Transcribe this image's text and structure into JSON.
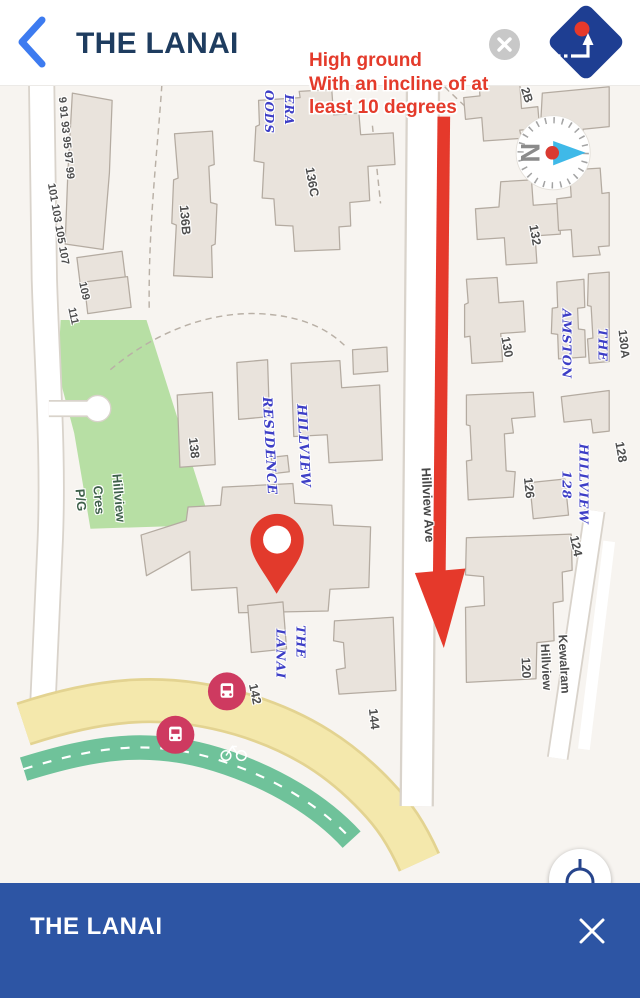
{
  "header": {
    "title": "THE LANAI"
  },
  "annotation": {
    "lines": [
      "High ground",
      "With an incline of at",
      "least 10 degrees"
    ]
  },
  "bottom_bar": {
    "title": "THE LANAI"
  },
  "compass": {
    "cardinal": "N"
  },
  "theme": {
    "bar_blue": "#2d55a4",
    "logo_blue": "#1e3e92",
    "header_title_navy": "#1e3c5f",
    "back_chevron_blue": "#3d7bf0",
    "annotation_red": "#e43b2b",
    "arrow_red": "#e5392b",
    "pin_red": "#e23a2c",
    "bus_stop_pink": "#ce3a60",
    "park_green": "#b7dfa4",
    "road_yellow": "#f4e8ac",
    "cycle_path_teal": "#6fc29a",
    "condo_label_blue": "#3d3ec6",
    "building_fill": "#e9e3dc",
    "map_background": "#f7f4f0"
  },
  "icons": {
    "header": [
      "back-chevron-icon",
      "close-circle-icon",
      "app-logo-diamond-icon"
    ],
    "map": [
      "compass-rose-icon",
      "map-pin-icon",
      "bus-stop-icon",
      "bicycle-icon",
      "my-location-icon"
    ],
    "bottom_bar": [
      "close-x-icon"
    ]
  },
  "map": {
    "labels": [
      {
        "text": "9 91 93 95 97 99",
        "x": 66,
        "y": 138,
        "rot": 84,
        "cls": "num",
        "size": 11
      },
      {
        "text": "101 103 105 107",
        "x": 58,
        "y": 224,
        "rot": 80,
        "cls": "num",
        "size": 11
      },
      {
        "text": "109",
        "x": 84,
        "y": 291,
        "rot": 78,
        "cls": "num",
        "size": 11
      },
      {
        "text": "111",
        "x": 73,
        "y": 316,
        "rot": 78,
        "cls": "num",
        "size": 11
      },
      {
        "text": "136B",
        "x": 185,
        "y": 220,
        "rot": 85,
        "cls": "num",
        "size": 12.5
      },
      {
        "text": "136C",
        "x": 312,
        "y": 182,
        "rot": 80,
        "cls": "num",
        "size": 12.5
      },
      {
        "text": "ERA",
        "x": 289,
        "y": 110,
        "rot": 90,
        "cls": "condo",
        "size": 12
      },
      {
        "text": "OODS",
        "x": 269,
        "y": 112,
        "rot": 90,
        "cls": "condo",
        "size": 12
      },
      {
        "text": "2B",
        "x": 527,
        "y": 95,
        "rot": 72,
        "cls": "num",
        "size": 12
      },
      {
        "text": "132",
        "x": 535,
        "y": 235,
        "rot": 80,
        "cls": "num",
        "size": 12.5
      },
      {
        "text": "130",
        "x": 507,
        "y": 347,
        "rot": 80,
        "cls": "num",
        "size": 12.5
      },
      {
        "text": "AMSTON",
        "x": 567,
        "y": 344,
        "rot": 90,
        "cls": "condo",
        "size": 12.5
      },
      {
        "text": "THE",
        "x": 603,
        "y": 345,
        "rot": 90,
        "cls": "condo",
        "size": 12.5
      },
      {
        "text": "130A",
        "x": 624,
        "y": 344,
        "rot": 84,
        "cls": "num",
        "size": 12
      },
      {
        "text": "126",
        "x": 529,
        "y": 488,
        "rot": 84,
        "cls": "num",
        "size": 12.5
      },
      {
        "text": "128",
        "x": 567,
        "y": 485,
        "rot": 90,
        "cls": "condo",
        "size": 12.5
      },
      {
        "text": "HILLVIEW",
        "x": 584,
        "y": 484,
        "rot": 90,
        "cls": "condo",
        "size": 12.5
      },
      {
        "text": "128",
        "x": 621,
        "y": 452,
        "rot": 80,
        "cls": "num",
        "size": 12.5
      },
      {
        "text": "124",
        "x": 576,
        "y": 546,
        "rot": 78,
        "cls": "num",
        "size": 12.5
      },
      {
        "text": "Kewalram",
        "x": 564,
        "y": 664,
        "rot": 87,
        "cls": "num",
        "size": 12.5
      },
      {
        "text": "Hillview",
        "x": 546,
        "y": 667,
        "rot": 87,
        "cls": "num",
        "size": 12.5
      },
      {
        "text": "120",
        "x": 526,
        "y": 668,
        "rot": 87,
        "cls": "num",
        "size": 12.5
      },
      {
        "text": "Hillview Ave",
        "x": 428,
        "y": 505,
        "rot": 87,
        "cls": "street",
        "size": 13
      },
      {
        "text": "Hillview",
        "x": 119,
        "y": 498,
        "rot": 85,
        "cls": "park",
        "size": 13
      },
      {
        "text": "Cres",
        "x": 99,
        "y": 500,
        "rot": 85,
        "cls": "park",
        "size": 13
      },
      {
        "text": "P/G",
        "x": 81,
        "y": 500,
        "rot": 85,
        "cls": "park",
        "size": 13
      },
      {
        "text": "RESIDENCE",
        "x": 269,
        "y": 446,
        "rot": 87,
        "cls": "condo",
        "size": 13
      },
      {
        "text": "HILLVIEW",
        "x": 303,
        "y": 446,
        "rot": 87,
        "cls": "condo",
        "size": 13
      },
      {
        "text": "138",
        "x": 194,
        "y": 448,
        "rot": 84,
        "cls": "num",
        "size": 12.5
      },
      {
        "text": "THE",
        "x": 301,
        "y": 642,
        "rot": 90,
        "cls": "condo",
        "size": 12.5
      },
      {
        "text": "LANAI",
        "x": 281,
        "y": 654,
        "rot": 90,
        "cls": "condo",
        "size": 12.5
      },
      {
        "text": "142",
        "x": 255,
        "y": 694,
        "rot": 78,
        "cls": "num",
        "size": 12.5
      },
      {
        "text": "144",
        "x": 374,
        "y": 719,
        "rot": 84,
        "cls": "num",
        "size": 12.5
      }
    ]
  }
}
